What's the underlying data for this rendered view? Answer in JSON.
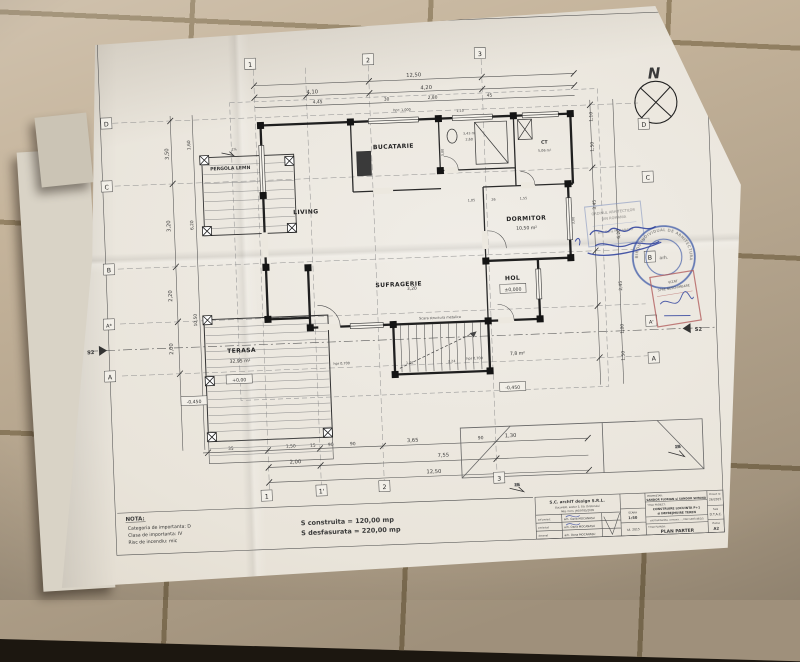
{
  "plan": {
    "north": "N",
    "rooms": {
      "bucatarie": "BUCATARIE",
      "living": "LIVING",
      "dormitor": "DORMITOR",
      "dormitor_area": "10,50 m²",
      "sufragerie": "SUFRAGERIE",
      "hol": "HOL",
      "hol_level": "±0,000",
      "ct": "CT",
      "ct_area": "5,06 m²",
      "porch_area": "7,8 m²",
      "terasa": "TERASA",
      "terasa_area": "32,95 m²",
      "terasa_level": "+0,00",
      "pergola": "PERGOLA LEMN",
      "stairs": "Scara structura metalica",
      "level_left": "-0,450",
      "level_right": "-0,450",
      "hpr_left": "hpr 0,700",
      "hpr_right": "hpr 0,700",
      "hpr_kitchen": "hpr: 1,000",
      "slope": "1%"
    },
    "grid": {
      "t1": "1",
      "t2": "2",
      "t3": "3",
      "b1": "1",
      "b1p": "1'",
      "b2": "2",
      "b3": "3",
      "l1": "D",
      "l2": "C",
      "l3": "B",
      "l4": "A*",
      "l5": "A",
      "r1": "D",
      "r2": "C",
      "r3": "B",
      "r4": "A'",
      "r5": "A",
      "sec_left": "S2",
      "sec_right": "S2"
    },
    "dims": {
      "top_total": "12,50",
      "t1": "4,10",
      "t2": "4,20",
      "t3": "4,45",
      "t4": "30",
      "t5": "2,80",
      "t6": "45",
      "t7": "1,10",
      "t8": "2,60",
      "t9": "3,43 m",
      "b1": "35",
      "b2": "1,50",
      "b3": "15",
      "b4": "90",
      "b5": "90",
      "b6": "3,65",
      "b7": "90",
      "b8": "1,30",
      "b9": "2,00",
      "b10": "7,55",
      "bottom_total": "12,50",
      "l1": "3,50",
      "l2": "3,20",
      "l3": "2,20",
      "l4": "2,00",
      "l5": "1,60",
      "l6": "6,20",
      "l7": "10,50",
      "r1": "1,10",
      "r2": "1,50",
      "r3": "3,45",
      "r4": "6,20",
      "r5": "2,45",
      "r6": "1,00",
      "r7": "1,50",
      "i1": "3,00",
      "i2": "3,20",
      "i3": "1,02",
      "i4": "2,24",
      "i5": "1,05",
      "i6": "26",
      "i7": "1,55",
      "i8": "3,00"
    }
  },
  "nota": {
    "title": "NOTA:",
    "line1": "Categoria de importanta: D",
    "line2": "Clasa de importanta: IV",
    "line3": "Risc de incendiu: mic",
    "area1": "S construita = 120,00 mp",
    "area2": "S desfasurata = 220,00 mp"
  },
  "titleblock": {
    "company": "S.C. archIT design S.R.L.",
    "company_line2": "Bucuresti, sector 3, Str. Dristorului",
    "company_line3": "Reg. Com. J40/9785/2005",
    "role1": "sef proiect",
    "role2": "proiectat",
    "role3": "desenat",
    "name1": "arh. Oana MOCANASU",
    "name2": "arh. Oana MOCANASU",
    "name3": "arh. Oana MOCANASU",
    "scara_label": "SCARA",
    "scara_value": "1:50",
    "date_value": "iul. 2015",
    "owner_label": "PROPRIETAR:",
    "owner_value": "SANDOR FLORIAN si SANDOR SIMONA",
    "project_label": "TITLU PROIECT:",
    "project_line1": "CONSTRUIRE LOCUINTA P+1",
    "project_line2": "si IMPREJMUIRE TEREN",
    "address": "sat Dambenita, comuna ..., CAD 1487/48/2/5",
    "sheet_label": "TITLU PLANSA:",
    "sheet_value": "PLAN PARTER",
    "proj_no_label": "Proiect nr.",
    "proj_no_value": "26/2015",
    "faza_label": "Faza",
    "faza_value": "D.T.A.C.",
    "plansa_label": "Plansa",
    "plansa_value": "A2"
  },
  "stamps": {
    "round_arc": "BIROU INDIVIDUAL DE ARHITECTURA",
    "round_center": "arh.",
    "oar_line1": "ORDINUL ARHITECTILOR",
    "oar_line2": "DIN ROMANIA",
    "oar_line3": "arh. Oana MOCANASU",
    "red_line1": "VIZAT",
    "red_line2": "SPRE NESCHIMBARE"
  },
  "colors": {
    "ink_blue": "#2b3e9c",
    "stamp_blue": "#4a63ab",
    "stamp_red": "#b35f5f",
    "paper": "#ece8df",
    "tile": "#c2b096"
  }
}
